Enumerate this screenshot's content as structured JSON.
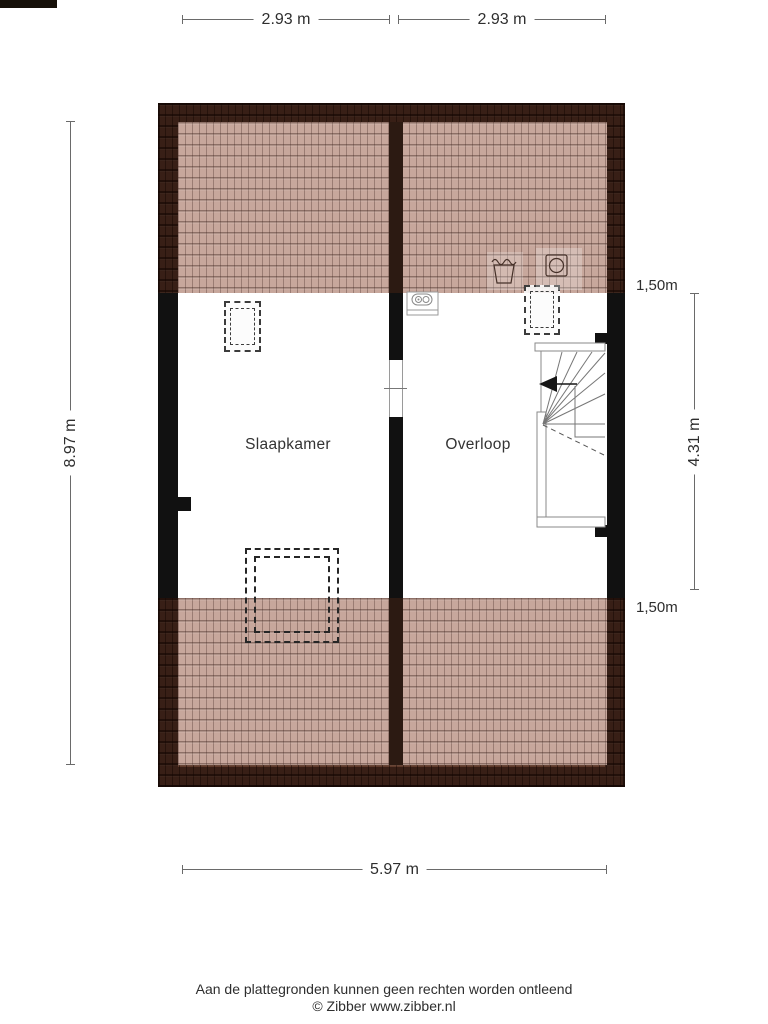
{
  "dimensions": {
    "top_left": "2.93 m",
    "top_right": "2.93 m",
    "left_total": "8.97 m",
    "right_headroom_top": "1,50m",
    "right_middle": "4.31 m",
    "right_headroom_bottom": "1,50m",
    "bottom_total": "5.97 m"
  },
  "rooms": [
    {
      "name": "Slaapkamer"
    },
    {
      "name": "Overloop"
    }
  ],
  "footer": {
    "disclaimer": "Aan de plattegronden kunnen geen rechten worden ontleend",
    "credit": "© Zibber www.zibber.nl"
  },
  "icons": {
    "stair_arrow": "stair-direction-arrow-icon",
    "laundry_tub": "laundry-tub-icon",
    "washing_machine": "washing-machine-icon",
    "ventilation_unit": "ventilation-unit-icon",
    "skylight": "skylight-dashed-outline",
    "dormer": "dormer-dashed-outline"
  },
  "colors": {
    "roof_dark": "#5f3a2b",
    "roof_edge": "#1a0903",
    "roof_low_headroom_overlay": "#c7a79c",
    "wall": "#111111",
    "dimension_line": "#6a6a6a",
    "text": "#2e2e2e"
  }
}
